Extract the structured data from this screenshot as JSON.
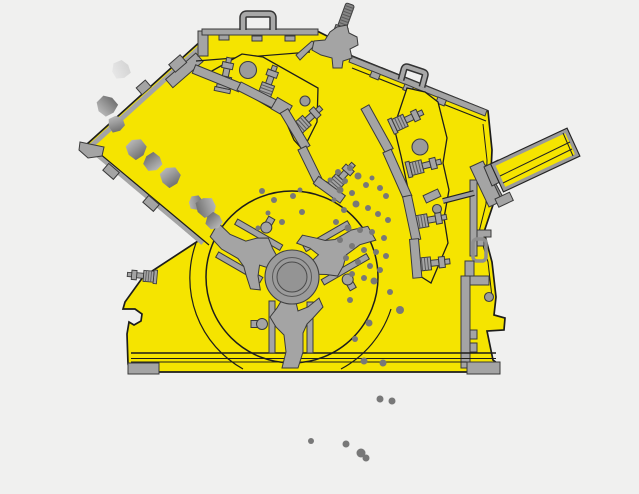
{
  "meta": {
    "type": "technical-illustration",
    "subject": "impact crusher cross-section diagram",
    "width": 639,
    "height": 494
  },
  "colors": {
    "background": "#f0f0ef",
    "housing_yellow": "#f5e400",
    "outline": "#1d1d1b",
    "metal_gray": "#a4a4a4",
    "metal_dark": "#8b8b8b",
    "metal_stroke": "#3a3a3a",
    "hub_gray": "#9b9b9b",
    "particle_gray": "#787878",
    "rock_shade_light": "#c8c8c8",
    "rock_shade_dark": "#5f5f5f",
    "rock_pale_light": "#ececec",
    "rock_pale_dark": "#cfcfcf",
    "cylinder_border": "#9a9a9a"
  },
  "parts": {
    "housing": "crusher housing",
    "feed_chute": "inclined feed chute",
    "upper_wall": "upper housing wall",
    "top_cover": "top cover",
    "lifting_handles": "lifting handles",
    "adjustment_rod": "threaded adjustment rod",
    "first_apron": "primary impact apron with spring tension bolts",
    "second_apron": "secondary impact apron with spring tension bolts",
    "rotor": "rotor with three blow bars",
    "rotor_hub": "rotor hub",
    "hydraulic_cylinder": "hydraulic apron-adjustment cylinder",
    "tension_rod": "apron tension rod",
    "base_frame": "base frame with mounting feet",
    "feed_rocks": "feed material rocks",
    "crushed_particles": "crushed material particles"
  },
  "feed_rocks": [
    {
      "x": 121,
      "y": 70,
      "r": 10,
      "pale": true
    },
    {
      "x": 107,
      "y": 106,
      "r": 11,
      "pale": false
    },
    {
      "x": 116,
      "y": 124,
      "r": 9,
      "pale": false
    },
    {
      "x": 136,
      "y": 149,
      "r": 11,
      "pale": false
    },
    {
      "x": 153,
      "y": 162,
      "r": 10,
      "pale": false
    },
    {
      "x": 170,
      "y": 177,
      "r": 11,
      "pale": false
    },
    {
      "x": 196,
      "y": 203,
      "r": 8,
      "pale": false
    },
    {
      "x": 206,
      "y": 207,
      "r": 11,
      "pale": false
    },
    {
      "x": 214,
      "y": 221,
      "r": 9,
      "pale": false
    }
  ],
  "chamber_particles": [
    [
      262,
      191,
      3
    ],
    [
      274,
      200,
      3
    ],
    [
      268,
      213,
      2.5
    ],
    [
      282,
      222,
      3
    ],
    [
      258,
      228,
      2.5
    ],
    [
      293,
      196,
      3
    ],
    [
      302,
      212,
      3
    ],
    [
      300,
      190,
      2.5
    ],
    [
      330,
      180,
      2.5
    ],
    [
      334,
      200,
      2.5
    ],
    [
      338,
      172,
      3
    ],
    [
      350,
      168,
      3
    ],
    [
      345,
      181,
      3
    ],
    [
      358,
      176,
      3.5
    ],
    [
      366,
      185,
      3
    ],
    [
      340,
      190,
      3.5
    ],
    [
      352,
      193,
      3
    ],
    [
      372,
      178,
      2.5
    ],
    [
      380,
      188,
      3
    ],
    [
      386,
      196,
      3
    ],
    [
      356,
      204,
      3.5
    ],
    [
      344,
      210,
      3
    ],
    [
      368,
      208,
      3
    ],
    [
      378,
      214,
      3
    ],
    [
      388,
      220,
      3
    ],
    [
      336,
      222,
      3
    ],
    [
      348,
      228,
      3.5
    ],
    [
      360,
      230,
      3
    ],
    [
      372,
      232,
      3
    ],
    [
      384,
      238,
      3
    ],
    [
      340,
      240,
      3
    ],
    [
      352,
      246,
      3
    ],
    [
      364,
      250,
      3
    ],
    [
      376,
      252,
      3
    ],
    [
      386,
      256,
      3
    ],
    [
      346,
      258,
      3
    ],
    [
      358,
      262,
      3
    ],
    [
      370,
      266,
      3
    ],
    [
      380,
      270,
      3
    ],
    [
      352,
      274,
      3
    ],
    [
      364,
      278,
      3
    ],
    [
      374,
      281,
      3.5
    ],
    [
      390,
      292,
      3
    ],
    [
      350,
      300,
      3
    ],
    [
      400,
      310,
      4
    ],
    [
      369,
      323,
      3.5
    ],
    [
      355,
      339,
      3
    ],
    [
      364,
      361,
      3.5
    ],
    [
      383,
      363,
      3.5
    ]
  ],
  "falling_particles": [
    [
      380,
      399,
      3.5
    ],
    [
      392,
      401,
      3.5
    ],
    [
      311,
      441,
      3
    ],
    [
      346,
      444,
      3.5
    ],
    [
      361,
      453,
      4.5
    ],
    [
      366,
      458,
      3.5
    ]
  ]
}
